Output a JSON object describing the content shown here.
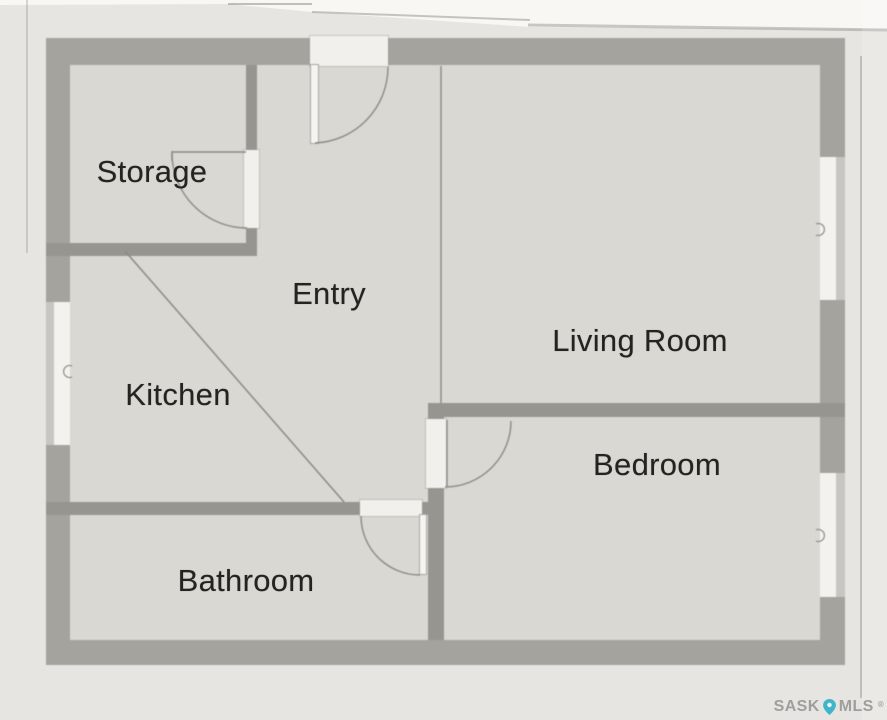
{
  "rooms": [
    {
      "label": "Storage"
    },
    {
      "label": "Entry"
    },
    {
      "label": "Kitchen"
    },
    {
      "label": "Living Room"
    },
    {
      "label": "Bedroom"
    },
    {
      "label": "Bathroom"
    }
  ],
  "watermark": {
    "sask": "SASK",
    "mls": "MLS",
    "reg": "®",
    "pin_icon": "map-pin-icon",
    "pin_color": "#3eb5c9",
    "text_color": "#9e9e9c"
  },
  "colors": {
    "page_background": "#e7e5e1",
    "paper_band": "#f8f7f4",
    "floor": "#d9d8d2",
    "exterior_wall": "#a4a39e",
    "interior_wall": "#96958f",
    "window": "#f3f2ef",
    "line": "#8b8a85",
    "label_text": "#232321"
  }
}
